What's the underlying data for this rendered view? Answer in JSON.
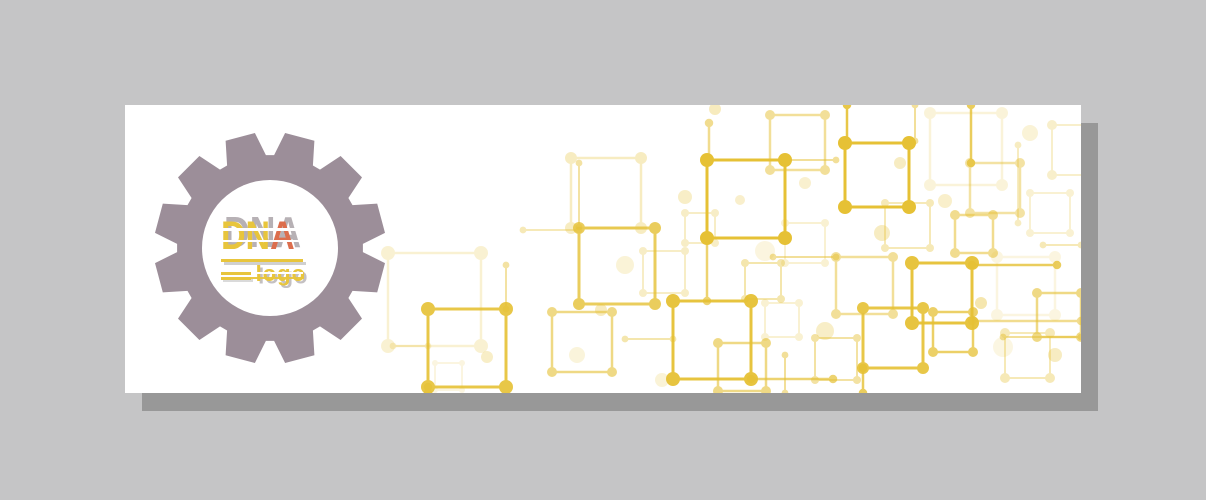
{
  "page": {
    "background": "#c5c5c6"
  },
  "banner": {
    "background": "#ffffff",
    "shadow_color": "#989898"
  },
  "logo": {
    "main": "DNA",
    "main_dn": "DN",
    "main_a": "A",
    "sub": "logo",
    "yellow": "#e8c53c",
    "orange": "#dc6e4d",
    "ghost_gray": "#b7b1b5",
    "gear_color": "#9c8e99"
  },
  "decor": {
    "stroke": "#e6c135",
    "squares": [
      {
        "x": 582,
        "y": 55,
        "s": 78,
        "o": 1,
        "w": 3,
        "r": 7
      },
      {
        "x": 720,
        "y": 38,
        "s": 64,
        "o": 1,
        "w": 3,
        "r": 7
      },
      {
        "x": 787,
        "y": 158,
        "s": 60,
        "o": 0.95,
        "w": 3,
        "r": 7
      },
      {
        "x": 548,
        "y": 196,
        "s": 78,
        "o": 0.95,
        "w": 3,
        "r": 7
      },
      {
        "x": 454,
        "y": 123,
        "s": 76,
        "o": 0.8,
        "w": 3,
        "r": 6
      },
      {
        "x": 303,
        "y": 204,
        "s": 78,
        "o": 0.9,
        "w": 3,
        "r": 7
      },
      {
        "x": 738,
        "y": 203,
        "s": 60,
        "o": 0.9,
        "w": 3,
        "r": 6
      },
      {
        "x": 808,
        "y": 207,
        "s": 40,
        "o": 0.75,
        "w": 2.5,
        "r": 5
      },
      {
        "x": 427,
        "y": 207,
        "s": 60,
        "o": 0.6,
        "w": 2.5,
        "r": 5
      },
      {
        "x": 711,
        "y": 152,
        "s": 57,
        "o": 0.5,
        "w": 2.5,
        "r": 5
      },
      {
        "x": 645,
        "y": 10,
        "s": 55,
        "o": 0.5,
        "w": 2.5,
        "r": 5
      },
      {
        "x": 593,
        "y": 238,
        "s": 48,
        "o": 0.6,
        "w": 2.5,
        "r": 5
      },
      {
        "x": 830,
        "y": 110,
        "s": 38,
        "o": 0.55,
        "w": 2.5,
        "r": 5
      },
      {
        "x": 912,
        "y": 188,
        "s": 44,
        "o": 0.6,
        "w": 2.5,
        "r": 5
      },
      {
        "x": 845,
        "y": 58,
        "s": 50,
        "o": 0.45,
        "w": 2.5,
        "r": 5
      },
      {
        "x": 690,
        "y": 233,
        "s": 42,
        "o": 0.45,
        "w": 2,
        "r": 4
      },
      {
        "x": 760,
        "y": 98,
        "s": 45,
        "o": 0.35,
        "w": 2,
        "r": 4
      },
      {
        "x": 620,
        "y": 158,
        "s": 36,
        "o": 0.4,
        "w": 2,
        "r": 4
      },
      {
        "x": 880,
        "y": 228,
        "s": 45,
        "o": 0.35,
        "w": 2,
        "r": 5
      },
      {
        "x": 446,
        "y": 53,
        "s": 70,
        "o": 0.3,
        "w": 2.5,
        "r": 6
      },
      {
        "x": 263,
        "y": 148,
        "s": 93,
        "o": 0.22,
        "w": 2.5,
        "r": 7
      },
      {
        "x": 805,
        "y": 8,
        "s": 72,
        "o": 0.18,
        "w": 2.5,
        "r": 6
      },
      {
        "x": 872,
        "y": 152,
        "s": 58,
        "o": 0.15,
        "w": 2.5,
        "r": 6
      },
      {
        "x": 518,
        "y": 146,
        "s": 42,
        "o": 0.28,
        "w": 2,
        "r": 4
      },
      {
        "x": 660,
        "y": 118,
        "s": 40,
        "o": 0.22,
        "w": 2,
        "r": 4
      },
      {
        "x": 905,
        "y": 88,
        "s": 40,
        "o": 0.22,
        "w": 2,
        "r": 4
      },
      {
        "x": 560,
        "y": 108,
        "s": 30,
        "o": 0.28,
        "w": 2,
        "r": 4
      },
      {
        "x": 640,
        "y": 198,
        "s": 34,
        "o": 0.22,
        "w": 2,
        "r": 4
      },
      {
        "x": 310,
        "y": 258,
        "s": 27,
        "o": 0.15,
        "w": 2,
        "r": 3
      },
      {
        "x": 927,
        "y": 20,
        "s": 50,
        "o": 0.25,
        "w": 2,
        "r": 5
      }
    ],
    "lines": [
      {
        "x1": 722,
        "y1": 0,
        "x2": 722,
        "y2": 38,
        "o": 0.9,
        "w": 2.5
      },
      {
        "x1": 584,
        "y1": 18,
        "x2": 584,
        "y2": 55,
        "o": 0.55,
        "w": 2.5
      },
      {
        "x1": 846,
        "y1": 0,
        "x2": 846,
        "y2": 58,
        "o": 0.8,
        "w": 2.5
      },
      {
        "x1": 790,
        "y1": 0,
        "x2": 790,
        "y2": 36,
        "o": 0.5,
        "w": 2
      },
      {
        "x1": 454,
        "y1": 58,
        "x2": 454,
        "y2": 122,
        "o": 0.45,
        "w": 2
      },
      {
        "x1": 398,
        "y1": 125,
        "x2": 454,
        "y2": 125,
        "o": 0.35,
        "w": 2
      },
      {
        "x1": 582,
        "y1": 133,
        "x2": 582,
        "y2": 196,
        "o": 0.7,
        "w": 2.5
      },
      {
        "x1": 847,
        "y1": 160,
        "x2": 932,
        "y2": 160,
        "o": 0.8,
        "w": 2.5
      },
      {
        "x1": 847,
        "y1": 216,
        "x2": 956,
        "y2": 216,
        "o": 0.55,
        "w": 2.5
      },
      {
        "x1": 626,
        "y1": 274,
        "x2": 708,
        "y2": 274,
        "o": 0.7,
        "w": 2.5
      },
      {
        "x1": 381,
        "y1": 160,
        "x2": 381,
        "y2": 204,
        "o": 0.45,
        "w": 2
      },
      {
        "x1": 738,
        "y1": 263,
        "x2": 738,
        "y2": 288,
        "o": 0.8,
        "w": 2.5
      },
      {
        "x1": 648,
        "y1": 152,
        "x2": 711,
        "y2": 152,
        "o": 0.5,
        "w": 2
      },
      {
        "x1": 878,
        "y1": 232,
        "x2": 956,
        "y2": 232,
        "o": 0.5,
        "w": 2
      },
      {
        "x1": 303,
        "y1": 282,
        "x2": 303,
        "y2": 288,
        "o": 0.6,
        "w": 2.5
      },
      {
        "x1": 500,
        "y1": 234,
        "x2": 548,
        "y2": 234,
        "o": 0.4,
        "w": 2
      },
      {
        "x1": 918,
        "y1": 140,
        "x2": 956,
        "y2": 140,
        "o": 0.35,
        "w": 2
      },
      {
        "x1": 893,
        "y1": 40,
        "x2": 893,
        "y2": 118,
        "o": 0.3,
        "w": 2
      },
      {
        "x1": 268,
        "y1": 241,
        "x2": 303,
        "y2": 241,
        "o": 0.25,
        "w": 2
      },
      {
        "x1": 660,
        "y1": 250,
        "x2": 660,
        "y2": 288,
        "o": 0.5,
        "w": 2
      },
      {
        "x1": 660,
        "y1": 55,
        "x2": 711,
        "y2": 55,
        "o": 0.5,
        "w": 2
      }
    ],
    "dots": [
      {
        "x": 500,
        "y": 160,
        "r": 9,
        "o": 0.2
      },
      {
        "x": 560,
        "y": 92,
        "r": 7,
        "o": 0.28
      },
      {
        "x": 640,
        "y": 146,
        "r": 10,
        "o": 0.16
      },
      {
        "x": 757,
        "y": 128,
        "r": 8,
        "o": 0.3
      },
      {
        "x": 820,
        "y": 96,
        "r": 7,
        "o": 0.26
      },
      {
        "x": 700,
        "y": 226,
        "r": 9,
        "o": 0.28
      },
      {
        "x": 452,
        "y": 250,
        "r": 8,
        "o": 0.18
      },
      {
        "x": 362,
        "y": 252,
        "r": 6,
        "o": 0.28
      },
      {
        "x": 878,
        "y": 242,
        "r": 10,
        "o": 0.14
      },
      {
        "x": 905,
        "y": 28,
        "r": 8,
        "o": 0.2
      },
      {
        "x": 537,
        "y": 275,
        "r": 7,
        "o": 0.2
      },
      {
        "x": 930,
        "y": 250,
        "r": 7,
        "o": 0.3
      },
      {
        "x": 590,
        "y": 4,
        "r": 6,
        "o": 0.32
      },
      {
        "x": 680,
        "y": 78,
        "r": 6,
        "o": 0.24
      },
      {
        "x": 775,
        "y": 58,
        "r": 6,
        "o": 0.3
      },
      {
        "x": 856,
        "y": 198,
        "r": 6,
        "o": 0.4
      },
      {
        "x": 476,
        "y": 205,
        "r": 6,
        "o": 0.32
      },
      {
        "x": 615,
        "y": 95,
        "r": 5,
        "o": 0.25
      }
    ]
  }
}
